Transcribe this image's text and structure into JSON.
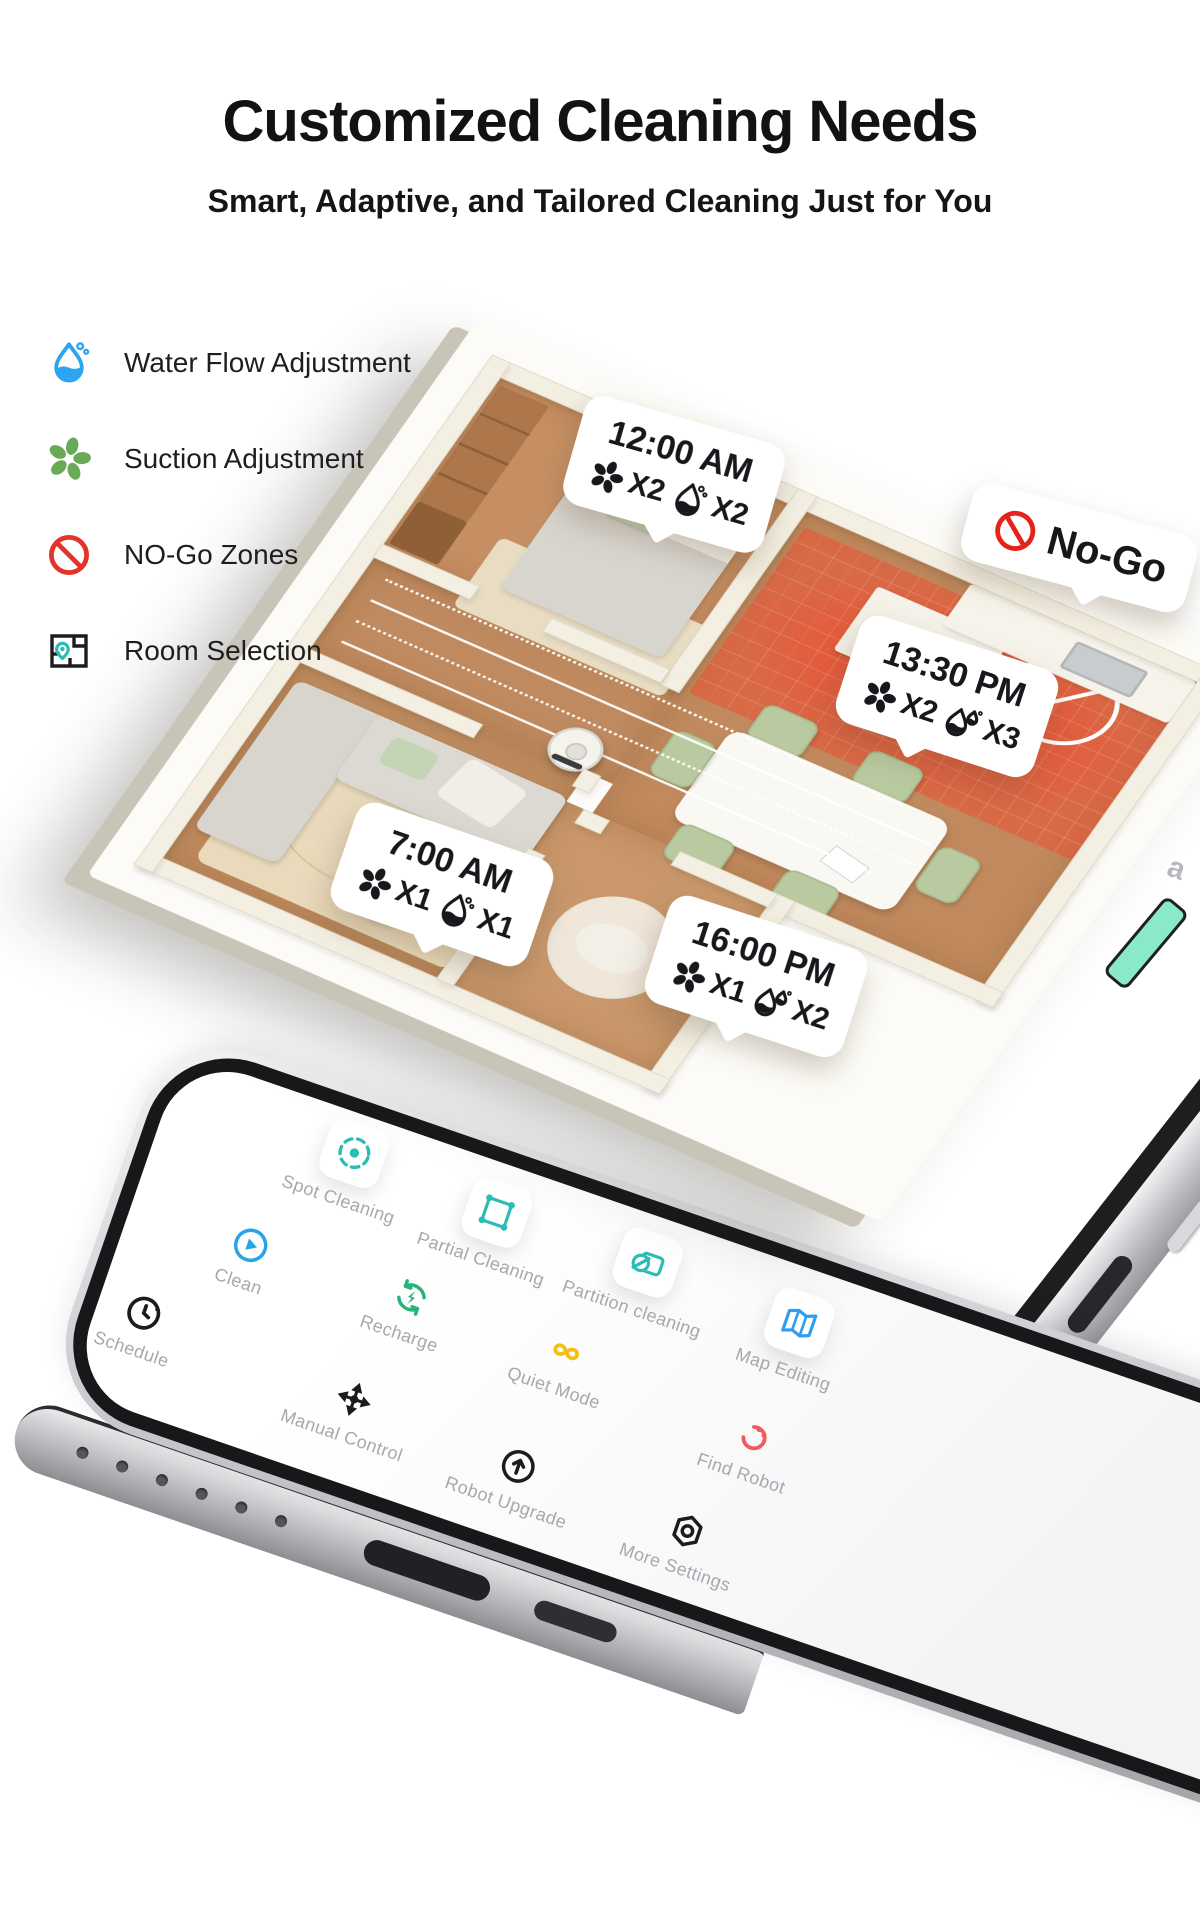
{
  "header": {
    "title": "Customized Cleaning Needs",
    "subtitle": "Smart, Adaptive, and Tailored Cleaning Just for You"
  },
  "features": [
    {
      "icon": "water-drop-icon",
      "label": "Water Flow Adjustment",
      "color": "#2ba5f0"
    },
    {
      "icon": "suction-fan-icon",
      "label": "Suction Adjustment",
      "color": "#69aa58"
    },
    {
      "icon": "no-go-ban-icon",
      "label": "NO-Go Zones",
      "color": "#e5332a"
    },
    {
      "icon": "room-selection-icon",
      "label": "Room Selection",
      "color": "#2bbdb5"
    }
  ],
  "floorplan": {
    "no_go_label": "No-Go",
    "schedules": [
      {
        "time": "12:00 AM",
        "suction": "X2",
        "water": "X2",
        "color": "#e0569a"
      },
      {
        "time": "13:30 PM",
        "suction": "X2",
        "water": "X3",
        "color": "#18bdb0"
      },
      {
        "time": "7:00 AM",
        "suction": "X1",
        "water": "X1",
        "color": "#3d85ec"
      },
      {
        "time": "16:00 PM",
        "suction": "X1",
        "water": "X2",
        "color": "#47a13d"
      }
    ]
  },
  "phone": {
    "app_menu": [
      {
        "label": "Spot Cleaning",
        "icon": "spot-cleaning-icon",
        "color": "#2bbdb5"
      },
      {
        "label": "Partial Cleaning",
        "icon": "partial-cleaning-icon",
        "color": "#2bbdb5"
      },
      {
        "label": "Partition cleaning",
        "icon": "partition-cleaning-icon",
        "color": "#2bbdb5"
      },
      {
        "label": "Map Editing",
        "icon": "map-editing-icon",
        "color": "#2e9ef0"
      },
      {
        "label": "Clean",
        "icon": "clean-icon",
        "color": "#29a3e8"
      },
      {
        "label": "Recharge",
        "icon": "recharge-icon",
        "color": "#27b577"
      },
      {
        "label": "Quiet Mode",
        "icon": "quiet-mode-icon",
        "color": "#f2c114"
      },
      {
        "label": "Find Robot",
        "icon": "find-robot-icon",
        "color": "#f15b5b"
      },
      {
        "label": "Schedule",
        "icon": "schedule-icon",
        "color": "#1c1c1e"
      },
      {
        "label": "Manual Control",
        "icon": "manual-control-icon",
        "color": "#1c1c1e"
      },
      {
        "label": "Robot Upgrade",
        "icon": "robot-upgrade-icon",
        "color": "#1c1c1e"
      },
      {
        "label": "More Settings",
        "icon": "more-settings-icon",
        "color": "#1c1c1e"
      }
    ],
    "screen_glimpse": {
      "text_fragment": "a",
      "button_color": "#8ae9c6"
    }
  },
  "colors": {
    "background": "#ffffff",
    "title_text": "#121212",
    "wood_floor": "#c08a5e",
    "wall_cream": "#f3efe2",
    "no_go_zone_red": "#f3462d",
    "phone_frame_silver": "#c6c7cb",
    "app_label_gray": "#a7a8ac"
  }
}
